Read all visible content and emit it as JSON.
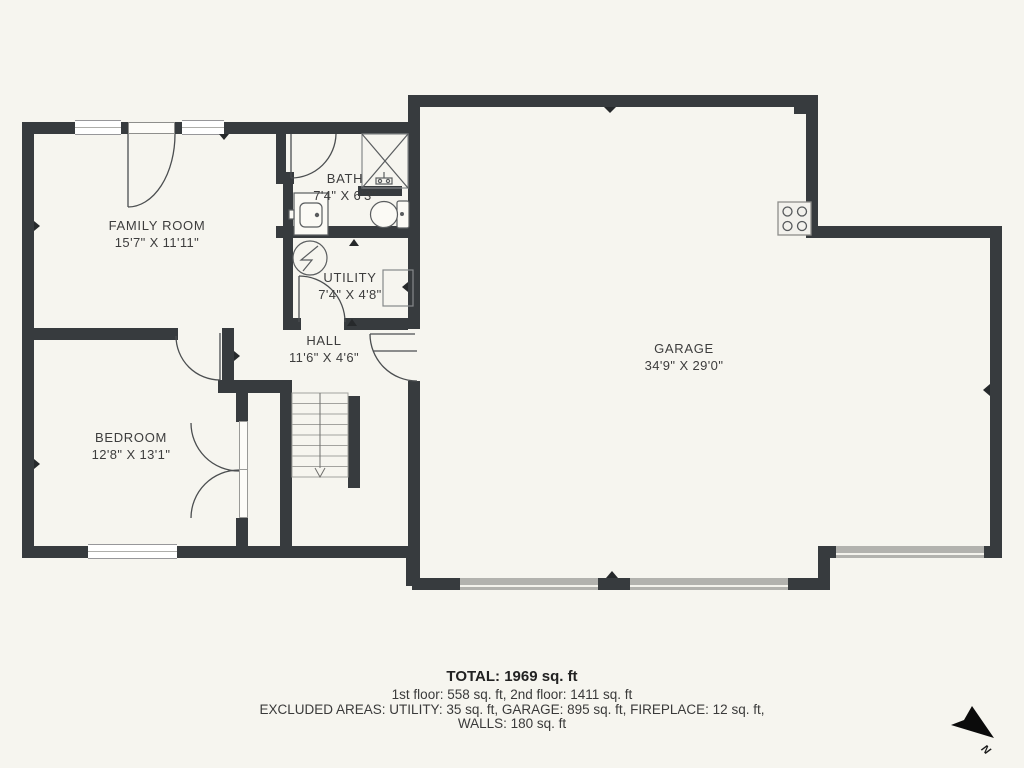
{
  "plan": {
    "rooms": [
      {
        "id": "family-room",
        "name": "FAMILY ROOM",
        "dims": "15'7\" X 11'11\""
      },
      {
        "id": "bath",
        "name": "BATH",
        "dims": "7'4\" X 6'3\""
      },
      {
        "id": "utility",
        "name": "UTILITY",
        "dims": "7'4\" X 4'8\""
      },
      {
        "id": "hall",
        "name": "HALL",
        "dims": "11'6\" X 4'6\""
      },
      {
        "id": "bedroom",
        "name": "BEDROOM",
        "dims": "12'8\" X 13'1\""
      },
      {
        "id": "garage",
        "name": "GARAGE",
        "dims": "34'9\" X 29'0\""
      }
    ],
    "summary": {
      "total": "TOTAL: 1969 sq. ft",
      "floors": "1st floor: 558 sq. ft, 2nd floor: 1411 sq. ft",
      "excluded": "EXCLUDED AREAS: UTILITY: 35 sq. ft, GARAGE: 895 sq. ft, FIREPLACE: 12 sq. ft,",
      "walls": "WALLS: 180 sq. ft"
    },
    "compass": {
      "label": "N"
    },
    "colors": {
      "wall": "#373b3e",
      "background": "#f6f5ef",
      "text": "#3d3d3d"
    }
  }
}
